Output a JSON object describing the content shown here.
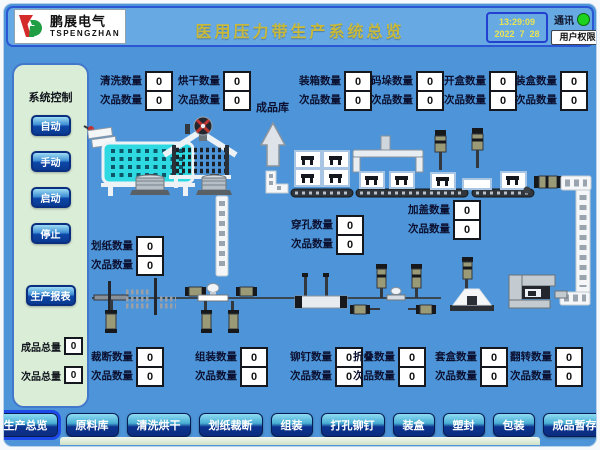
{
  "header": {
    "logo": {
      "name": "鹏展电气",
      "sub": "TSPENGZHAN"
    },
    "title": "医用压力带生产系统总览",
    "clock": {
      "time": "13:29:09",
      "date": "2022  7  28"
    },
    "comm_label": "通讯",
    "comm_status_color": "#1ed31e",
    "user_button": "用户权限"
  },
  "sidebar": {
    "title": "系统控制",
    "mode_buttons": [
      {
        "id": "auto",
        "label": "自动"
      },
      {
        "id": "manual",
        "label": "手动"
      },
      {
        "id": "start",
        "label": "启动"
      },
      {
        "id": "stop",
        "label": "停止"
      }
    ],
    "report_button": "生产报表",
    "totals": [
      {
        "label": "成品总量",
        "value": "0"
      },
      {
        "label": "次品总量",
        "value": "0"
      }
    ]
  },
  "plant": {
    "warehouse_label": "成品库",
    "counters": [
      {
        "id": "wash",
        "label": "清洗数量",
        "value": "0",
        "defect_label": "次品数量",
        "defect_value": "0"
      },
      {
        "id": "dry",
        "label": "烘干数量",
        "value": "0",
        "defect_label": "次品数量",
        "defect_value": "0"
      },
      {
        "id": "boxing",
        "label": "装箱数量",
        "value": "0",
        "defect_label": "次品数量",
        "defect_value": "0"
      },
      {
        "id": "palletize",
        "label": "码垛数量",
        "value": "0",
        "defect_label": "次品数量",
        "defect_value": "0"
      },
      {
        "id": "unbox",
        "label": "开盒数量",
        "value": "0",
        "defect_label": "次品数量",
        "defect_value": "0"
      },
      {
        "id": "casing",
        "label": "装盒数量",
        "value": "0",
        "defect_label": "次品数量",
        "defect_value": "0"
      },
      {
        "id": "punch",
        "label": "穿孔数量",
        "value": "0",
        "defect_label": "次品数量",
        "defect_value": "0"
      },
      {
        "id": "cap",
        "label": "加盖数量",
        "value": "0",
        "defect_label": "次品数量",
        "defect_value": "0"
      },
      {
        "id": "paper",
        "label": "划纸数量",
        "value": "0",
        "defect_label": "次品数量",
        "defect_value": "0"
      },
      {
        "id": "cut",
        "label": "裁断数量",
        "value": "0",
        "defect_label": "次品数量",
        "defect_value": "0"
      },
      {
        "id": "assemble",
        "label": "组装数量",
        "value": "0",
        "defect_label": "次品数量",
        "defect_value": "0"
      },
      {
        "id": "rivet",
        "label": "铆钉数量",
        "value": "0",
        "defect_label": "次品数量",
        "defect_value": "0"
      },
      {
        "id": "fold",
        "label": "折叠数量",
        "value": "0",
        "defect_label": "次品数量",
        "defect_value": "0"
      },
      {
        "id": "nest",
        "label": "套盒数量",
        "value": "0",
        "defect_label": "次品数量",
        "defect_value": "0"
      },
      {
        "id": "flip",
        "label": "翻转数量",
        "value": "0",
        "defect_label": "次品数量",
        "defect_value": "0"
      }
    ]
  },
  "nav": {
    "items": [
      {
        "id": "overview",
        "label": "生产总览",
        "active": true
      },
      {
        "id": "material-store",
        "label": "原料库"
      },
      {
        "id": "wash-dry",
        "label": "清洗烘干"
      },
      {
        "id": "paper-cut",
        "label": "划纸裁断"
      },
      {
        "id": "assembly",
        "label": "组装"
      },
      {
        "id": "punch-rivet",
        "label": "打孔铆钉"
      },
      {
        "id": "box-loading",
        "label": "装盒"
      },
      {
        "id": "seal",
        "label": "塑封"
      },
      {
        "id": "packaging",
        "label": "包装"
      },
      {
        "id": "product-storage",
        "label": "成品暂存"
      }
    ]
  }
}
